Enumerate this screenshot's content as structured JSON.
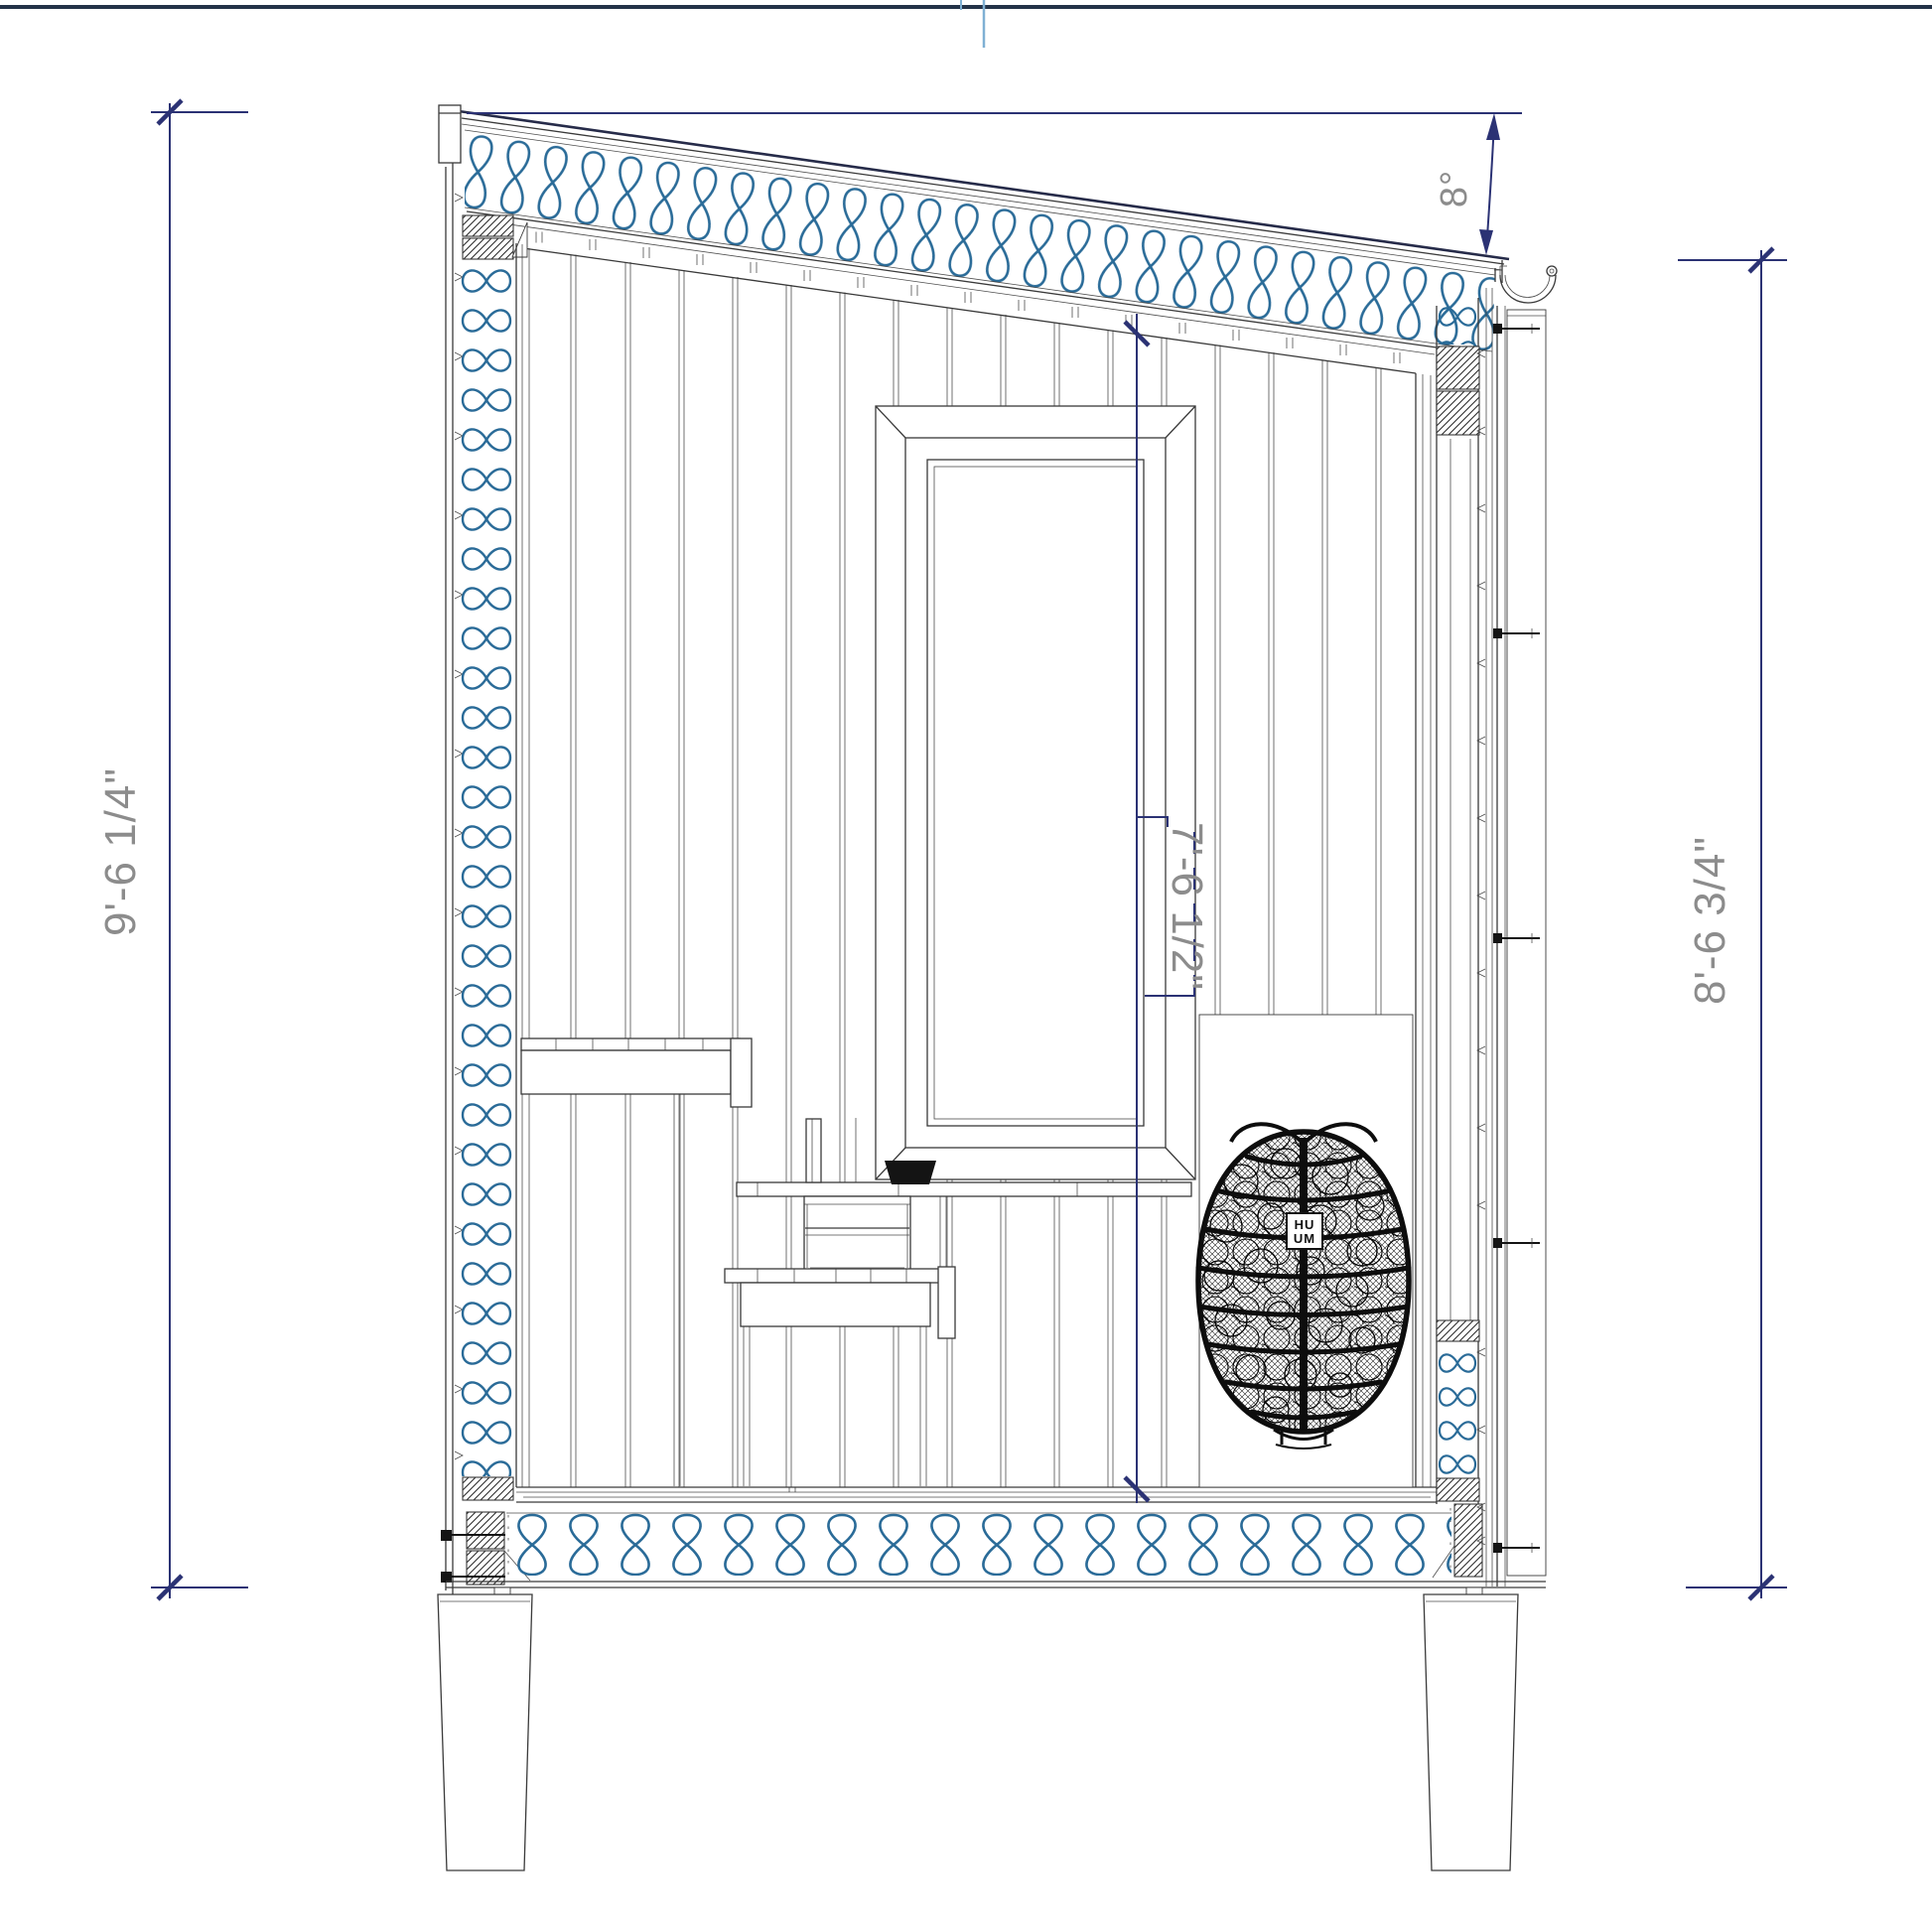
{
  "page": {
    "background": "#ffffff"
  },
  "colors": {
    "dimline": "#2b3274",
    "dimtext": "#8c8c8c",
    "insulation": "#2a6b98",
    "ink": "#3a3a3a",
    "roofline": "#262b49",
    "border": "#233348",
    "croptick": "#7fb0d4",
    "solid": "#141414"
  },
  "dimensions": {
    "overall_height_left": "9'-6 1/4\"",
    "interior_clear_height": "7'-6 1/2\"",
    "wall_height_right": "8'-6 3/4\"",
    "roof_slope_angle": "8°"
  },
  "heater": {
    "brand_top": "HU",
    "brand_bottom": "UM"
  }
}
